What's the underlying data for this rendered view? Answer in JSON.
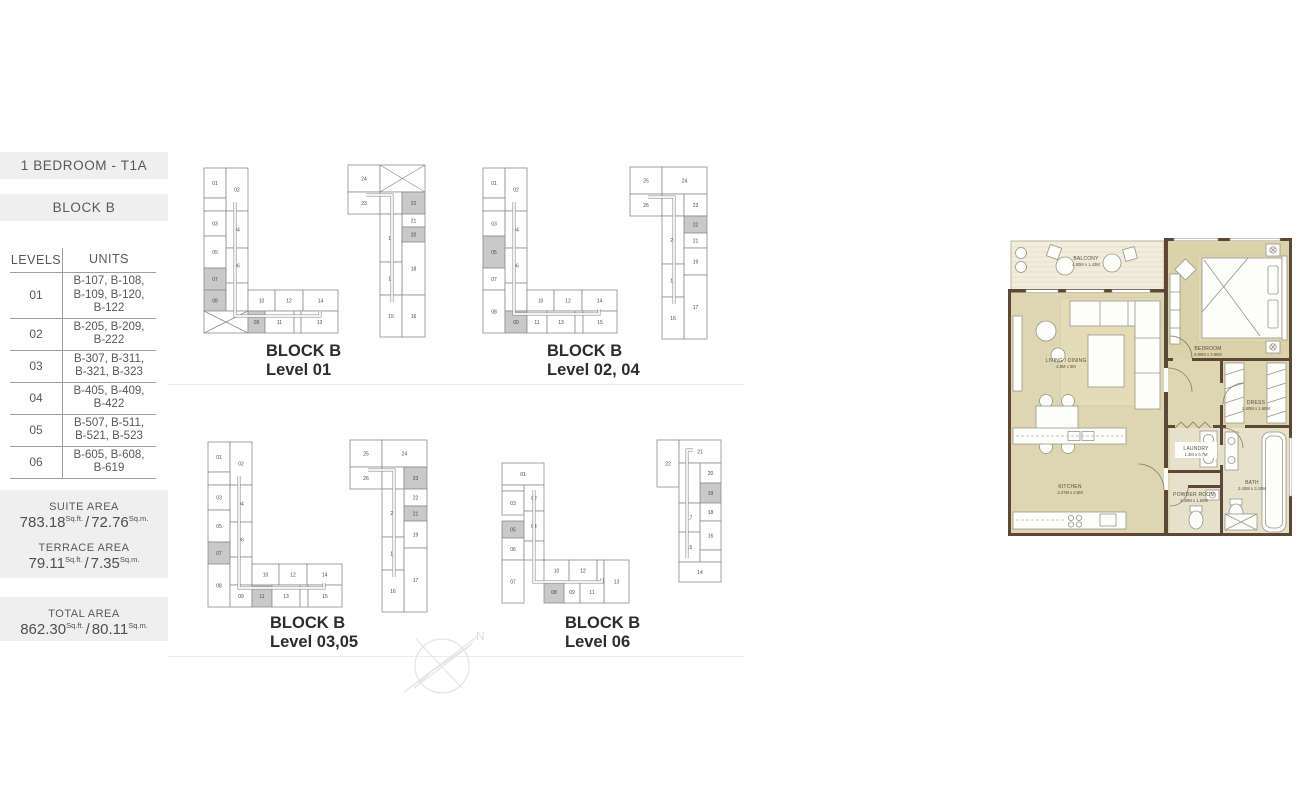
{
  "sidebar": {
    "unit_type": "1 BEDROOM - T1A",
    "block": "BLOCK B",
    "table": {
      "headers": [
        "LEVELS",
        "UNITS"
      ],
      "rows": [
        {
          "level": "01",
          "units": [
            "B-107, B-108,",
            "B-109, B-120,",
            "B-122"
          ]
        },
        {
          "level": "02",
          "units": [
            "B-205, B-209,",
            "B-222"
          ]
        },
        {
          "level": "03",
          "units": [
            "B-307, B-311,",
            "B-321, B-323"
          ]
        },
        {
          "level": "04",
          "units": [
            "B-405, B-409,",
            "B-422"
          ]
        },
        {
          "level": "05",
          "units": [
            "B-507, B-511,",
            "B-521, B-523"
          ]
        },
        {
          "level": "06",
          "units": [
            "B-605, B-608,",
            "B-619"
          ]
        }
      ]
    },
    "areas": {
      "units": {
        "sqft": "Sq.ft.",
        "sqm": "Sq.m.",
        "sep": "/"
      },
      "suite": {
        "label": "SUITE AREA",
        "sqft": "783.18",
        "sqm": "72.76"
      },
      "terrace": {
        "label": "TERRACE AREA",
        "sqft": "79.11",
        "sqm": "7.35"
      },
      "total": {
        "label": "TOTAL AREA",
        "sqft": "862.30",
        "sqm": "80.11"
      }
    }
  },
  "colors": {
    "header_bg": "#efefef",
    "cell_stroke": "#8c8c8c",
    "cell_highlight": "#c9c9c9",
    "cell_text": "#4a4a4a",
    "wall": "#5d4836",
    "room": "#ddd6b1",
    "room_wet": "#e7e1cb",
    "balcony": "#f1ecdb",
    "plan_text": "#55503e"
  },
  "compass": {
    "label": "N"
  },
  "diagrams": [
    {
      "caption1": "BLOCK B",
      "caption2": "Level 01",
      "left": {
        "ox": 4,
        "oy": 15,
        "corr": "M31,34 v114 h85 v-5",
        "cells": [
          [
            0,
            0,
            22,
            30,
            "01",
            ""
          ],
          [
            22,
            0,
            22,
            43,
            "02",
            ""
          ],
          [
            0,
            30,
            22,
            13,
            "",
            ""
          ],
          [
            0,
            43,
            22,
            25,
            "03",
            ""
          ],
          [
            22,
            43,
            22,
            37,
            "04",
            ""
          ],
          [
            0,
            68,
            22,
            32,
            "05",
            ""
          ],
          [
            22,
            80,
            22,
            35,
            "06",
            ""
          ],
          [
            0,
            100,
            22,
            22,
            "07",
            "hl"
          ],
          [
            0,
            122,
            22,
            21,
            "08",
            "hl"
          ],
          [
            22,
            115,
            22,
            28,
            "",
            ""
          ],
          [
            0,
            143,
            44,
            22,
            "",
            "x"
          ],
          [
            44,
            122,
            27,
            21,
            "10",
            ""
          ],
          [
            71,
            122,
            28,
            21,
            "12",
            ""
          ],
          [
            99,
            122,
            35,
            21,
            "14",
            ""
          ],
          [
            44,
            143,
            17,
            22,
            "09",
            "hl"
          ],
          [
            61,
            143,
            29,
            22,
            "11",
            ""
          ],
          [
            90,
            143,
            7,
            22,
            "",
            ""
          ],
          [
            97,
            143,
            37,
            22,
            "13",
            ""
          ]
        ]
      },
      "right": {
        "ox": 148,
        "oy": 12,
        "corr": "M18,30 h26 v107",
        "cells": [
          [
            0,
            0,
            32,
            27,
            "24",
            ""
          ],
          [
            32,
            0,
            45,
            27,
            "",
            "x"
          ],
          [
            0,
            27,
            32,
            22,
            "23",
            ""
          ],
          [
            32,
            27,
            22,
            22,
            "",
            ""
          ],
          [
            54,
            27,
            23,
            22,
            "22",
            "hl"
          ],
          [
            54,
            49,
            23,
            13,
            "21",
            ""
          ],
          [
            32,
            49,
            22,
            48,
            "19",
            ""
          ],
          [
            54,
            62,
            23,
            15,
            "20",
            "hl"
          ],
          [
            54,
            77,
            23,
            53,
            "18",
            ""
          ],
          [
            32,
            97,
            22,
            33,
            "17",
            ""
          ],
          [
            32,
            130,
            22,
            42,
            "15",
            ""
          ],
          [
            54,
            130,
            23,
            42,
            "16",
            ""
          ]
        ]
      }
    },
    {
      "caption1": "BLOCK B",
      "caption2": "Level 02, 04",
      "left": {
        "ox": 4,
        "oy": 15,
        "corr": "M31,34 v112 h85 v-5",
        "cells": [
          [
            0,
            0,
            22,
            30,
            "01",
            ""
          ],
          [
            22,
            0,
            22,
            43,
            "02",
            ""
          ],
          [
            0,
            30,
            22,
            13,
            "",
            ""
          ],
          [
            0,
            43,
            22,
            25,
            "03",
            ""
          ],
          [
            22,
            43,
            22,
            37,
            "04",
            ""
          ],
          [
            0,
            68,
            22,
            32,
            "05",
            "hl"
          ],
          [
            22,
            80,
            22,
            35,
            "06",
            ""
          ],
          [
            0,
            100,
            22,
            22,
            "07",
            ""
          ],
          [
            0,
            122,
            22,
            43,
            "08",
            ""
          ],
          [
            22,
            115,
            22,
            28,
            "",
            ""
          ],
          [
            44,
            122,
            27,
            21,
            "10",
            ""
          ],
          [
            71,
            122,
            28,
            21,
            "12",
            ""
          ],
          [
            99,
            122,
            35,
            21,
            "14",
            ""
          ],
          [
            22,
            143,
            22,
            22,
            "09",
            "hl"
          ],
          [
            44,
            143,
            20,
            22,
            "11",
            ""
          ],
          [
            64,
            143,
            28,
            22,
            "13",
            ""
          ],
          [
            92,
            143,
            8,
            22,
            "",
            ""
          ],
          [
            100,
            143,
            34,
            22,
            "15",
            ""
          ]
        ]
      },
      "right": {
        "ox": 151,
        "oy": 14,
        "corr": "M18,30 h26 v107",
        "cells": [
          [
            0,
            0,
            32,
            27,
            "25",
            ""
          ],
          [
            32,
            0,
            45,
            27,
            "24",
            ""
          ],
          [
            0,
            27,
            32,
            22,
            "26",
            ""
          ],
          [
            32,
            27,
            22,
            22,
            "",
            ""
          ],
          [
            54,
            27,
            23,
            22,
            "23",
            ""
          ],
          [
            54,
            49,
            23,
            17,
            "22",
            "hl"
          ],
          [
            54,
            66,
            23,
            15,
            "21",
            ""
          ],
          [
            32,
            49,
            22,
            48,
            "20",
            ""
          ],
          [
            54,
            81,
            23,
            27,
            "19",
            ""
          ],
          [
            32,
            97,
            22,
            33,
            "18",
            ""
          ],
          [
            54,
            108,
            23,
            64,
            "17",
            ""
          ],
          [
            32,
            130,
            22,
            42,
            "16",
            ""
          ]
        ]
      }
    },
    {
      "caption1": "BLOCK B",
      "caption2": "Level 03,05",
      "left": {
        "ox": 4,
        "oy": 15,
        "corr": "M31,34 v112 h85 v-5",
        "cells": [
          [
            0,
            0,
            22,
            30,
            "01",
            ""
          ],
          [
            22,
            0,
            22,
            43,
            "02",
            ""
          ],
          [
            0,
            30,
            22,
            13,
            "",
            ""
          ],
          [
            0,
            43,
            22,
            25,
            "03",
            ""
          ],
          [
            22,
            43,
            22,
            37,
            "04",
            ""
          ],
          [
            0,
            68,
            22,
            32,
            "05",
            ""
          ],
          [
            22,
            80,
            22,
            35,
            "06",
            ""
          ],
          [
            0,
            100,
            22,
            22,
            "07",
            "hl"
          ],
          [
            0,
            122,
            22,
            43,
            "08",
            ""
          ],
          [
            22,
            115,
            22,
            28,
            "",
            ""
          ],
          [
            44,
            122,
            27,
            21,
            "10",
            ""
          ],
          [
            71,
            122,
            28,
            21,
            "12",
            ""
          ],
          [
            99,
            122,
            35,
            21,
            "14",
            ""
          ],
          [
            22,
            143,
            22,
            22,
            "09",
            ""
          ],
          [
            44,
            143,
            20,
            22,
            "11",
            "hl"
          ],
          [
            64,
            143,
            28,
            22,
            "13",
            ""
          ],
          [
            92,
            143,
            8,
            22,
            "",
            ""
          ],
          [
            100,
            143,
            34,
            22,
            "15",
            ""
          ]
        ]
      },
      "right": {
        "ox": 146,
        "oy": 13,
        "corr": "M18,30 h26 v107",
        "cells": [
          [
            0,
            0,
            32,
            27,
            "25",
            ""
          ],
          [
            32,
            0,
            45,
            27,
            "24",
            ""
          ],
          [
            0,
            27,
            32,
            22,
            "26",
            ""
          ],
          [
            32,
            27,
            22,
            22,
            "",
            ""
          ],
          [
            54,
            27,
            23,
            22,
            "23",
            "hl"
          ],
          [
            54,
            49,
            23,
            17,
            "22",
            ""
          ],
          [
            54,
            66,
            23,
            15,
            "21",
            "hl"
          ],
          [
            32,
            49,
            22,
            48,
            "20",
            ""
          ],
          [
            54,
            81,
            23,
            27,
            "19",
            ""
          ],
          [
            32,
            97,
            22,
            33,
            "18",
            ""
          ],
          [
            54,
            108,
            23,
            64,
            "17",
            ""
          ],
          [
            32,
            130,
            22,
            42,
            "16",
            ""
          ]
        ]
      }
    },
    {
      "caption1": "BLOCK B",
      "caption2": "Level 06",
      "left": {
        "ox": 5,
        "oy": 36,
        "corr": "M32,27 v92 h68 v-4",
        "cells": [
          [
            0,
            0,
            42,
            22,
            "01",
            ""
          ],
          [
            0,
            22,
            22,
            6,
            "",
            ""
          ],
          [
            0,
            28,
            22,
            24,
            "03",
            ""
          ],
          [
            22,
            22,
            20,
            26,
            "02",
            ""
          ],
          [
            0,
            58,
            22,
            17,
            "05",
            "hl"
          ],
          [
            22,
            48,
            20,
            30,
            "04",
            ""
          ],
          [
            0,
            75,
            22,
            22,
            "06",
            ""
          ],
          [
            0,
            97,
            22,
            43,
            "07",
            ""
          ],
          [
            22,
            78,
            20,
            19,
            "",
            ""
          ],
          [
            42,
            97,
            25,
            21,
            "10",
            ""
          ],
          [
            67,
            97,
            28,
            21,
            "12",
            ""
          ],
          [
            95,
            97,
            7,
            21,
            "",
            ""
          ],
          [
            102,
            97,
            25,
            43,
            "13",
            ""
          ],
          [
            42,
            118,
            20,
            22,
            "08",
            "hl"
          ],
          [
            62,
            118,
            16,
            22,
            "09",
            ""
          ],
          [
            78,
            118,
            24,
            22,
            "11",
            ""
          ]
        ]
      },
      "right": {
        "ox": 160,
        "oy": 13,
        "corr": "M36,10 h-6 v108",
        "cells": [
          [
            0,
            0,
            22,
            47,
            "22",
            ""
          ],
          [
            22,
            0,
            42,
            23,
            "21",
            ""
          ],
          [
            43,
            23,
            21,
            20,
            "20",
            ""
          ],
          [
            43,
            43,
            21,
            20,
            "19",
            "hl"
          ],
          [
            22,
            23,
            21,
            40,
            "",
            ""
          ],
          [
            43,
            63,
            21,
            18,
            "18",
            ""
          ],
          [
            22,
            63,
            21,
            29,
            "17",
            ""
          ],
          [
            43,
            81,
            21,
            29,
            "16",
            ""
          ],
          [
            22,
            92,
            21,
            30,
            "15",
            ""
          ],
          [
            43,
            110,
            21,
            12,
            "",
            ""
          ],
          [
            22,
            122,
            42,
            20,
            "14",
            ""
          ]
        ]
      }
    }
  ],
  "plan": {
    "rooms": [
      {
        "name": "BALCONY",
        "dims": "4.80M x 1.43M",
        "x": 78,
        "y": 22
      },
      {
        "name": "LIVING / DINING",
        "dims": "4.8M x 5M",
        "x": 58,
        "y": 124
      },
      {
        "name": "BEDROOM",
        "dims": "5.90M x 3.90M",
        "x": 200,
        "y": 112
      },
      {
        "name": "DRESS",
        "dims": "2.40M x 1.60M",
        "x": 248,
        "y": 166
      },
      {
        "name": "KITCHEN",
        "dims": "3.37M x 2.8M",
        "x": 62,
        "y": 250
      },
      {
        "name": "LAUNDRY",
        "dims": "1.4M x 0.7M",
        "x": 188,
        "y": 212
      },
      {
        "name": "POWDER ROOM",
        "dims": "1.40M x 1.50M",
        "x": 186,
        "y": 258
      },
      {
        "name": "BATH",
        "dims": "2.40M x 3.10M",
        "x": 244,
        "y": 246
      }
    ]
  }
}
